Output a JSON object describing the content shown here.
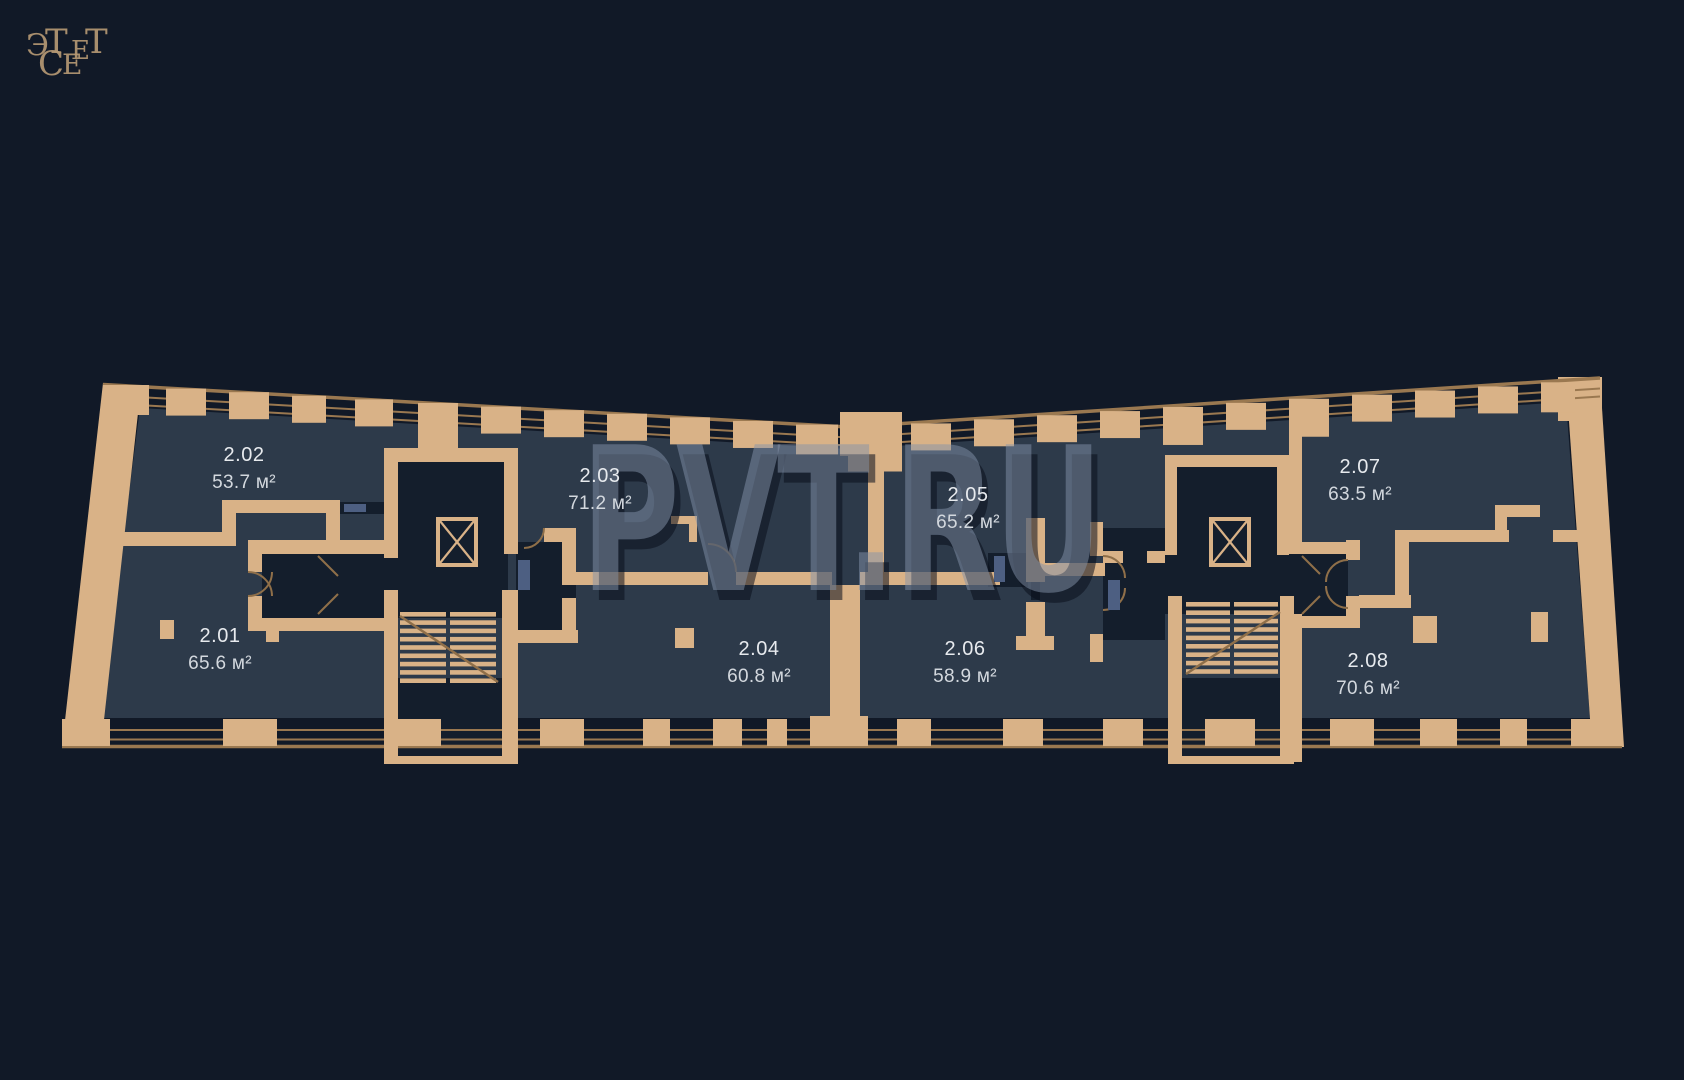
{
  "page": {
    "background_color": "#111927",
    "type": "residential-floor-plan"
  },
  "logo": {
    "brand": "ЭСТЕТ",
    "display": [
      "Э",
      "Т",
      "Е",
      "Т",
      "С",
      "Е"
    ],
    "color": "#b59874"
  },
  "watermark": {
    "text": "PVT.RU",
    "color": "rgba(132,146,170,0.5)"
  },
  "colors": {
    "wall": "#d9b287",
    "wall_line": "#9a7850",
    "apartment_fill": "#2d3a4a",
    "corridor_fill": "#141e2c",
    "label_text": "#e7eaee",
    "door_accent": "#4d5f82"
  },
  "apartments": [
    {
      "id": "2.01",
      "area": "65.6 м²",
      "x": 220,
      "y": 638
    },
    {
      "id": "2.02",
      "area": "53.7 м²",
      "x": 244,
      "y": 457
    },
    {
      "id": "2.03",
      "area": "71.2 м²",
      "x": 600,
      "y": 478
    },
    {
      "id": "2.04",
      "area": "60.8 м²",
      "x": 759,
      "y": 651
    },
    {
      "id": "2.05",
      "area": "65.2 м²",
      "x": 968,
      "y": 497
    },
    {
      "id": "2.06",
      "area": "58.9 м²",
      "x": 965,
      "y": 651
    },
    {
      "id": "2.07",
      "area": "63.5 м²",
      "x": 1360,
      "y": 469
    },
    {
      "id": "2.08",
      "area": "70.6 м²",
      "x": 1368,
      "y": 663
    }
  ]
}
